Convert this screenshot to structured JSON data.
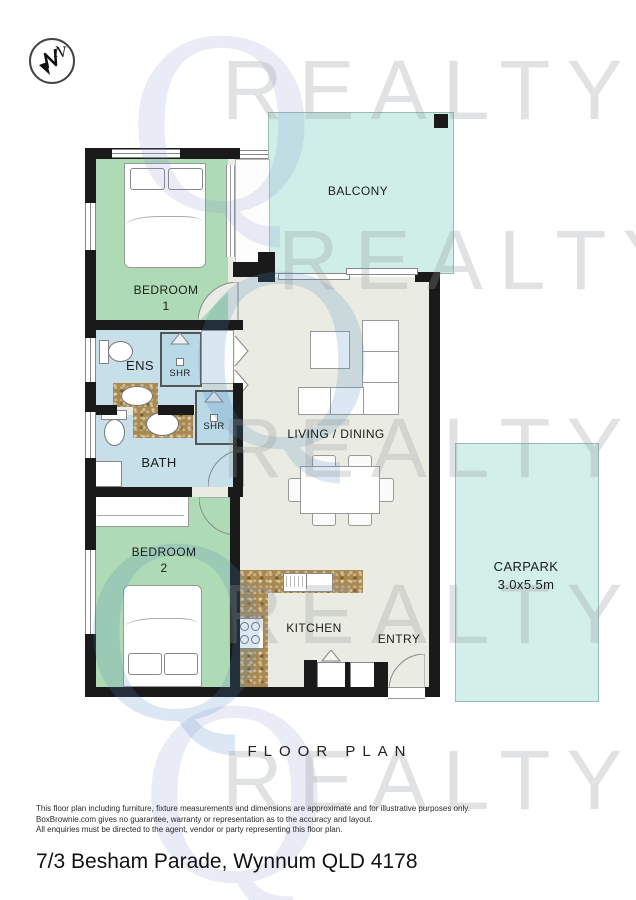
{
  "page": {
    "floor_plan_label": "FLOOR PLAN",
    "address": "7/3 Besham Parade, Wynnum QLD 4178",
    "disclaimer": {
      "line1": "This floor plan including furniture, fixture measurements and dimensions are approximate and for illustrative purposes only.",
      "line2": "BoxBrownie.com gives no guarantee, warranty or representation as to the accuracy and layout.",
      "line3": "All enquiries must be directed to the agent, vendor or party representing this floor plan."
    }
  },
  "compass": {
    "direction": "N"
  },
  "watermark": {
    "letter": "Q",
    "text": "REALTY"
  },
  "rooms": {
    "balcony": "BALCONY",
    "bedroom1_line1": "BEDROOM",
    "bedroom1_line2": "1",
    "ens": "ENS",
    "shr_ens": "SHR",
    "shr_bath": "SHR",
    "bath": "BATH",
    "bedroom2_line1": "BEDROOM",
    "bedroom2_line2": "2",
    "living": "LIVING / DINING",
    "kitchen": "KITCHEN",
    "entry": "ENTRY",
    "carpark_line1": "CARPARK",
    "carpark_line2": "3.0x5.5m"
  },
  "colors": {
    "wall": "#1a1a1a",
    "bedroom_fill": "#aedbb5",
    "bathroom_fill": "#c6dfe9",
    "shower_fill": "#b9d9e6",
    "balcony_fill": "#cfeee8",
    "carpark_fill": "#d3efe9",
    "living_fill": "#eaece3",
    "counter_fill": "#a9894f",
    "watermark_purple": "#7d87cd",
    "watermark_grey": "#919498"
  }
}
